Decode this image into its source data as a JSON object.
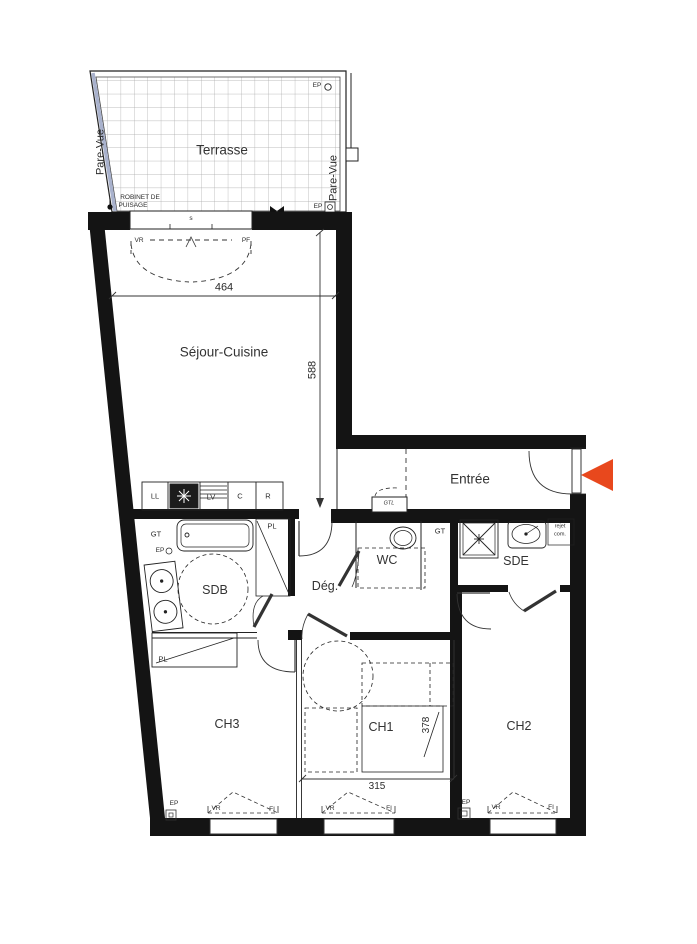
{
  "meta": {
    "type": "apartment floor plan",
    "accent_color": "#E8481D",
    "wall_color": "#141414",
    "terrace_rail_color": "#A9B2CD"
  },
  "terrace": {
    "label": "Terrasse",
    "screen_left": "Pare-Vue",
    "screen_right": "Pare-Vue",
    "ep_top": "EP",
    "ep_bottom": "EP",
    "tap_line1": "ROBINET DE",
    "tap_line2": "PUISAGE",
    "sill": "s"
  },
  "living": {
    "label": "Séjour-Cuisine",
    "door_left": "VR",
    "door_right": "PF",
    "width_cm": "464",
    "depth_cm": "588",
    "kitchen": {
      "washer": "LL",
      "dishwasher": "LV",
      "cooker": "C",
      "fridge": "R"
    }
  },
  "entrance": {
    "label": "Entrée",
    "gtl": "GTL"
  },
  "bathroom": {
    "label": "SDB",
    "gt": "GT",
    "ep": "EP",
    "closet": "PL"
  },
  "hall": {
    "label": "Dég."
  },
  "wc": {
    "label": "WC",
    "gt": "GT"
  },
  "shower_room": {
    "label": "SDE",
    "vent_line1": "rejet",
    "vent_line2": "com."
  },
  "bedroom1": {
    "label": "CH1",
    "depth_cm": "378",
    "width_cm": "315",
    "window_vr": "VR",
    "window_fi": "FI"
  },
  "bedroom2": {
    "label": "CH2",
    "window_vr": "VR",
    "window_fi": "FI",
    "ep": "EP"
  },
  "bedroom3": {
    "label": "CH3",
    "closet": "PL",
    "window_vr": "VR",
    "window_fi": "FI",
    "ep": "EP"
  }
}
